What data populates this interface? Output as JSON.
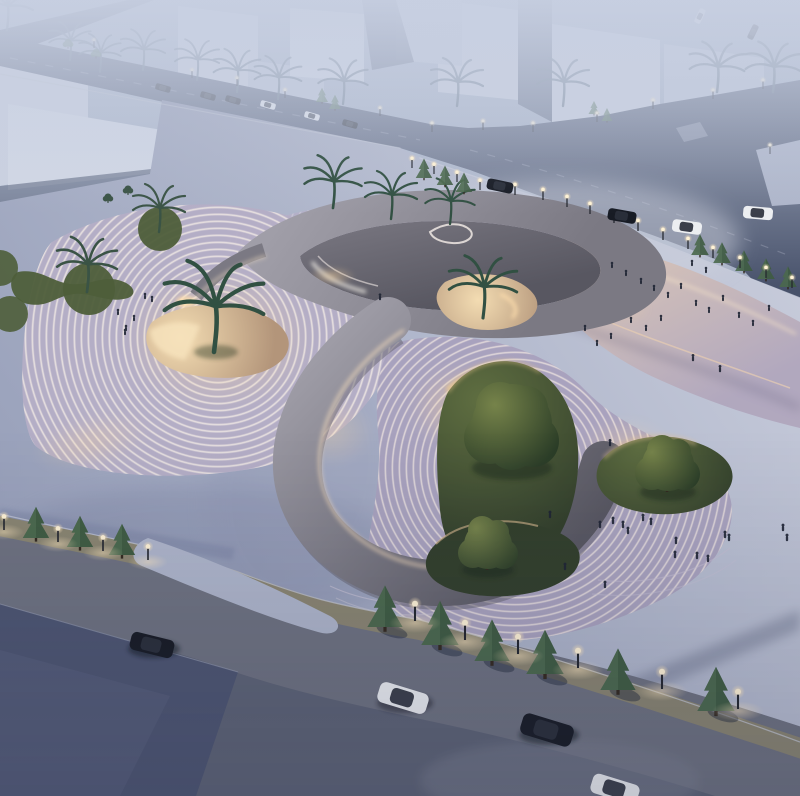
{
  "scene": {
    "type": "aerial-dusk-architectural-rendering",
    "subject": "organic-terraced-plaza-building",
    "landmarks": {
      "sunken_palm_courtyards": 3,
      "oval_lawn_islands": 3,
      "grass_circles": 4,
      "concrete_ribbon_loops": 2,
      "background_buildings": 9
    },
    "inventory": {
      "vehicles_white": 5,
      "vehicles_dark": 8,
      "street_lamps": 40,
      "palm_trees": 17,
      "conifer_trees": 17,
      "canopy_trees": 3,
      "pedestrians": 44
    }
  },
  "palette": {
    "sky_top": "#9fabc0",
    "sky_mid": "#a9b0c5",
    "haze": "#c8d0e2",
    "building": "#cbd1df",
    "building_light": "#d6dbe6",
    "building_shade": "#b9c1d3",
    "road_dark": "#47516a",
    "road_under": "#5d6375",
    "road_bottom": "#6e7280",
    "panel": "#4d5571",
    "median": "#8a8571",
    "curb": "#c6cbd9",
    "plaza_light": "#c8ccdb",
    "plaza": "#aeb5ca",
    "plaza_shadow": "#98a0ba",
    "stripe_light": "#f0e8e4",
    "stripe_dark": "#b5aec6",
    "stripe2_light": "#cfcad8",
    "stripe2_dark": "#b5afc8",
    "stripe3_light": "#e8dedd",
    "stripe3_dark": "#a8a1bd",
    "concrete_light": "#a09ea8",
    "concrete_dark": "#7b7983",
    "concrete_mid": "#75737d",
    "concrete_deep": "#585761",
    "sand": "#b3957a",
    "sand_lit": "#f3dcb2",
    "dune_top": "#dcc6b5",
    "dune_bottom": "#b0a6bd",
    "lawn_light": "#5f6e41",
    "lawn_dark": "#323f2b",
    "tree_light": "#76834a",
    "tree_dark": "#2b3d27",
    "palm": "#315042",
    "palm_dark": "#27413a",
    "palm_hazy": "#566878",
    "conifer": "#3f5c42",
    "conifer_far": "#4a6a4e",
    "lamp_glow": "#ffe8bf",
    "glow_warm": "#ffd9a0",
    "car_white": "#eceef1",
    "car_black": "#171b24",
    "person": "#1f2534",
    "trunk": "#33291f"
  }
}
